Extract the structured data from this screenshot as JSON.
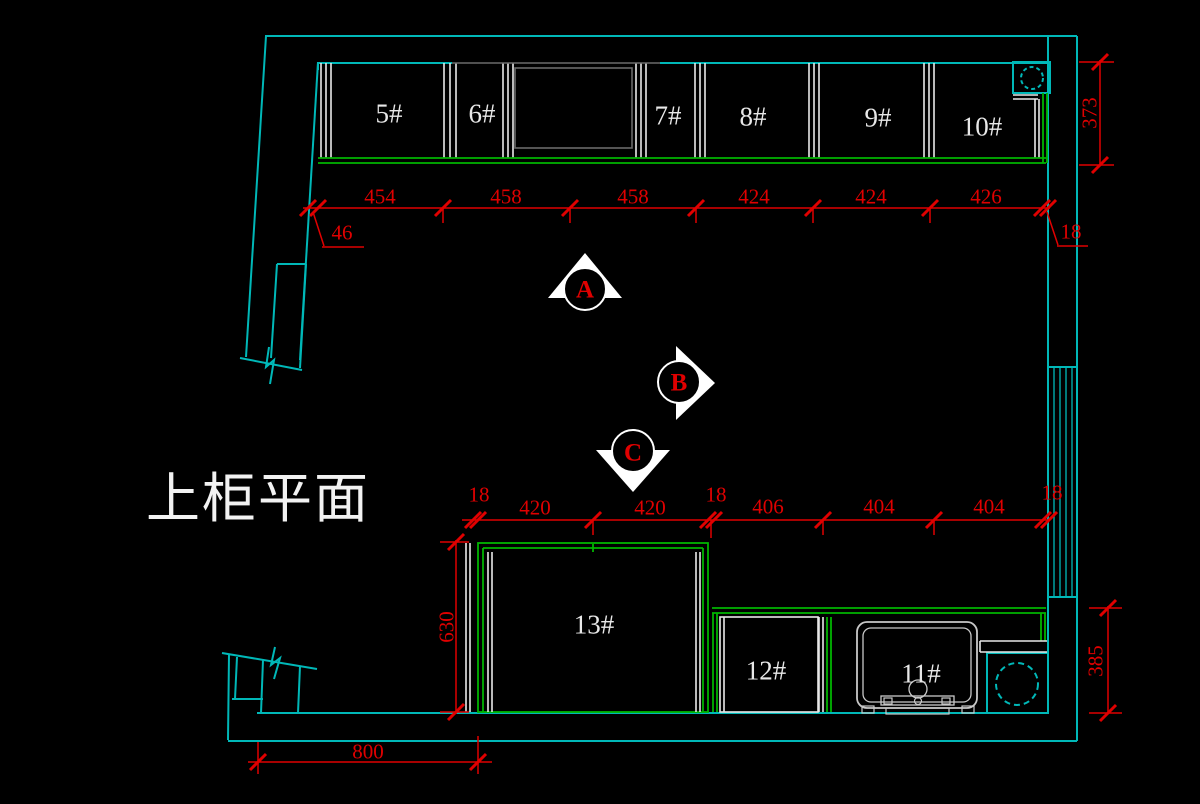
{
  "title": "上柜平面",
  "colors": {
    "background": "#000000",
    "wall": "#00b8b8",
    "cabinet_line": "#e8e8e8",
    "front_line": "#00b400",
    "dimension": "#e00000"
  },
  "cabinet_labels": {
    "top": [
      "5#",
      "6#",
      "7#",
      "8#",
      "9#",
      "10#"
    ],
    "bottom": [
      "13#",
      "12#",
      "11#"
    ]
  },
  "view_markers": [
    "A",
    "B",
    "C"
  ],
  "dimensions": {
    "top_run": [
      "454",
      "458",
      "458",
      "424",
      "424",
      "426"
    ],
    "top_left_offset": "46",
    "top_right_offset": "18",
    "right_upper": "373",
    "bottom_run": [
      "18",
      "420",
      "420",
      "18",
      "406",
      "404",
      "404",
      "18"
    ],
    "left_vertical": "630",
    "right_lower": "385",
    "bottom_wall": "800"
  }
}
